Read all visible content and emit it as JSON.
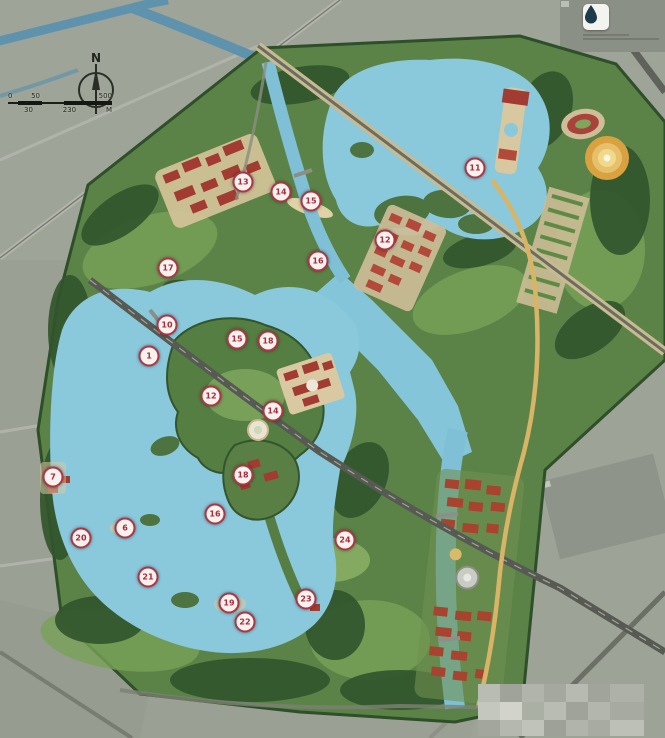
{
  "map": {
    "type": "landscape-masterplan-over-satellite",
    "north_label": "N",
    "scalebar": {
      "top_labels": [
        "0",
        "50",
        "500"
      ],
      "bottom_labels": [
        "30",
        "230",
        "M"
      ]
    },
    "logo": {
      "icon": "water-droplet-icon"
    },
    "colors": {
      "satellite_base": "#9aa094",
      "lake_blue": "#8ac8dc",
      "canal_blue": "#7fc0d6",
      "park_green": "#5b8347",
      "dark_trees": "#32552c",
      "meadow_green": "#86ac60",
      "red_buildings": "#a23b31",
      "sand_tan": "#d5c49c",
      "yellow_road": "#d8b566",
      "marker_ring": "#ab3646",
      "marker_text": "#a52d3e"
    },
    "markers": [
      {
        "x": 475,
        "y": 168,
        "label": "11"
      },
      {
        "x": 385,
        "y": 240,
        "label": "12"
      },
      {
        "x": 243,
        "y": 182,
        "label": "13"
      },
      {
        "x": 281,
        "y": 192,
        "label": "14"
      },
      {
        "x": 311,
        "y": 201,
        "label": "15"
      },
      {
        "x": 318,
        "y": 261,
        "label": "16"
      },
      {
        "x": 168,
        "y": 268,
        "label": "17"
      },
      {
        "x": 167,
        "y": 325,
        "label": "10"
      },
      {
        "x": 149,
        "y": 356,
        "label": "1"
      },
      {
        "x": 237,
        "y": 339,
        "label": "15"
      },
      {
        "x": 268,
        "y": 341,
        "label": "18"
      },
      {
        "x": 211,
        "y": 396,
        "label": "12"
      },
      {
        "x": 273,
        "y": 411,
        "label": "14"
      },
      {
        "x": 53,
        "y": 477,
        "label": "7"
      },
      {
        "x": 243,
        "y": 475,
        "label": "18"
      },
      {
        "x": 215,
        "y": 514,
        "label": "16"
      },
      {
        "x": 125,
        "y": 528,
        "label": "6"
      },
      {
        "x": 81,
        "y": 538,
        "label": "20"
      },
      {
        "x": 148,
        "y": 577,
        "label": "21"
      },
      {
        "x": 229,
        "y": 603,
        "label": "19"
      },
      {
        "x": 245,
        "y": 622,
        "label": "22"
      },
      {
        "x": 306,
        "y": 599,
        "label": "23"
      },
      {
        "x": 345,
        "y": 540,
        "label": "24"
      }
    ]
  }
}
